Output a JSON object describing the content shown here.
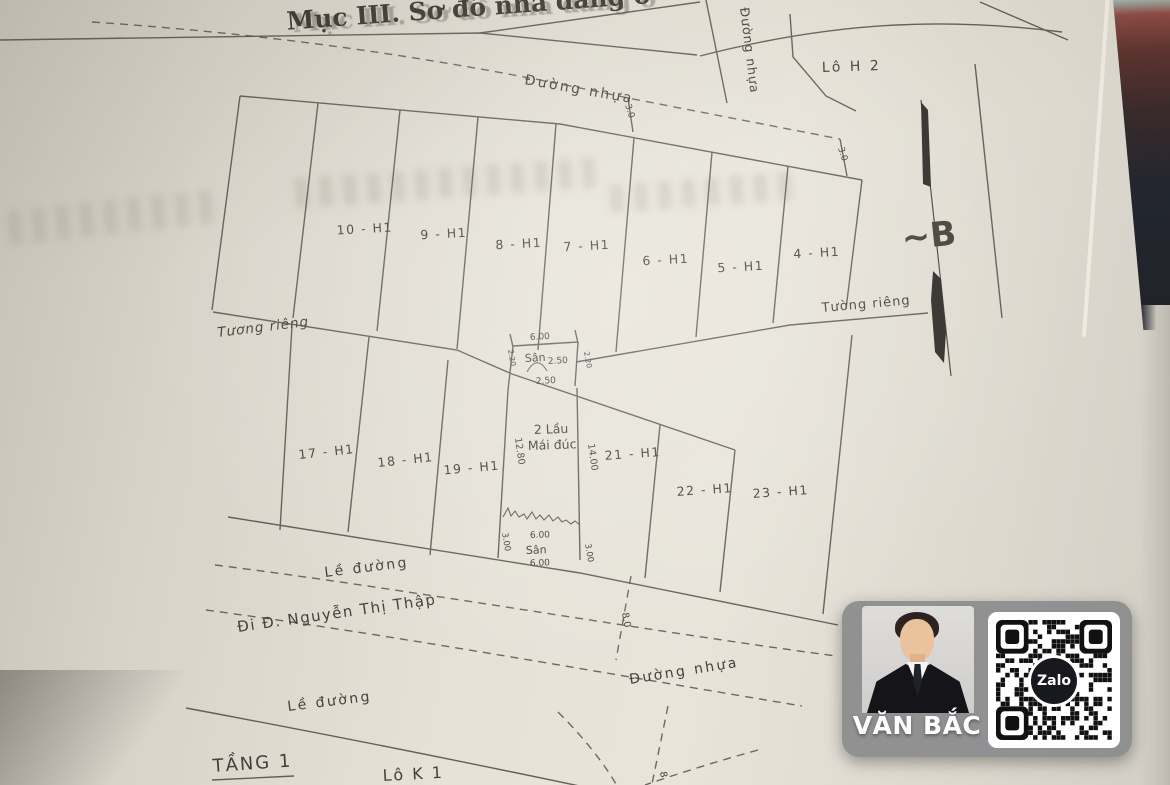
{
  "title": "Mục III. Sơ đồ nhà đang ở",
  "areas": {
    "lo_h2": "Lô H 2",
    "lo_k1": "Lô K 1",
    "tang1": "TẦNG 1",
    "north": "~B"
  },
  "roads": {
    "top": "Đường nhựa",
    "side": "Đường nhựa",
    "bottom": "Đường nhựa",
    "curb_top": "Lề đường",
    "curb_bottom": "Lề đường",
    "direction": "Đi Đ. Nguyễn Thị Thập"
  },
  "walls": {
    "left": "Tương riêng",
    "right": "Tường riêng"
  },
  "lots": {
    "top_row": [
      "10 - H1",
      "9 - H1",
      "8 - H1",
      "7 - H1",
      "6 - H1",
      "5 - H1",
      "4 - H1"
    ],
    "bottom_row": [
      "17 - H1",
      "18 - H1",
      "19 - H1",
      "21 - H1",
      "22 - H1",
      "23 - H1"
    ]
  },
  "house": {
    "floors": "2 Lầu",
    "roof": "Mái đúc",
    "yard_top": "Sân",
    "yard_bottom": "Sân"
  },
  "dims": {
    "front_width": "6.00",
    "yard_depth": "2.50",
    "indent": "2.50",
    "side_left": "2.20",
    "side_right": "2.20",
    "depth_left": "12.80",
    "depth_right": "14.00",
    "rear_width": "6.00",
    "rear_yard": "6.00",
    "rear_left": "3.00",
    "rear_right": "3.00",
    "alley_left": "3.0",
    "alley_right": "3.0",
    "road_width": "8.0",
    "road_width2": "8"
  },
  "watermark": {
    "name": "VĂN BẮC",
    "qr_brand": "Zalo"
  }
}
